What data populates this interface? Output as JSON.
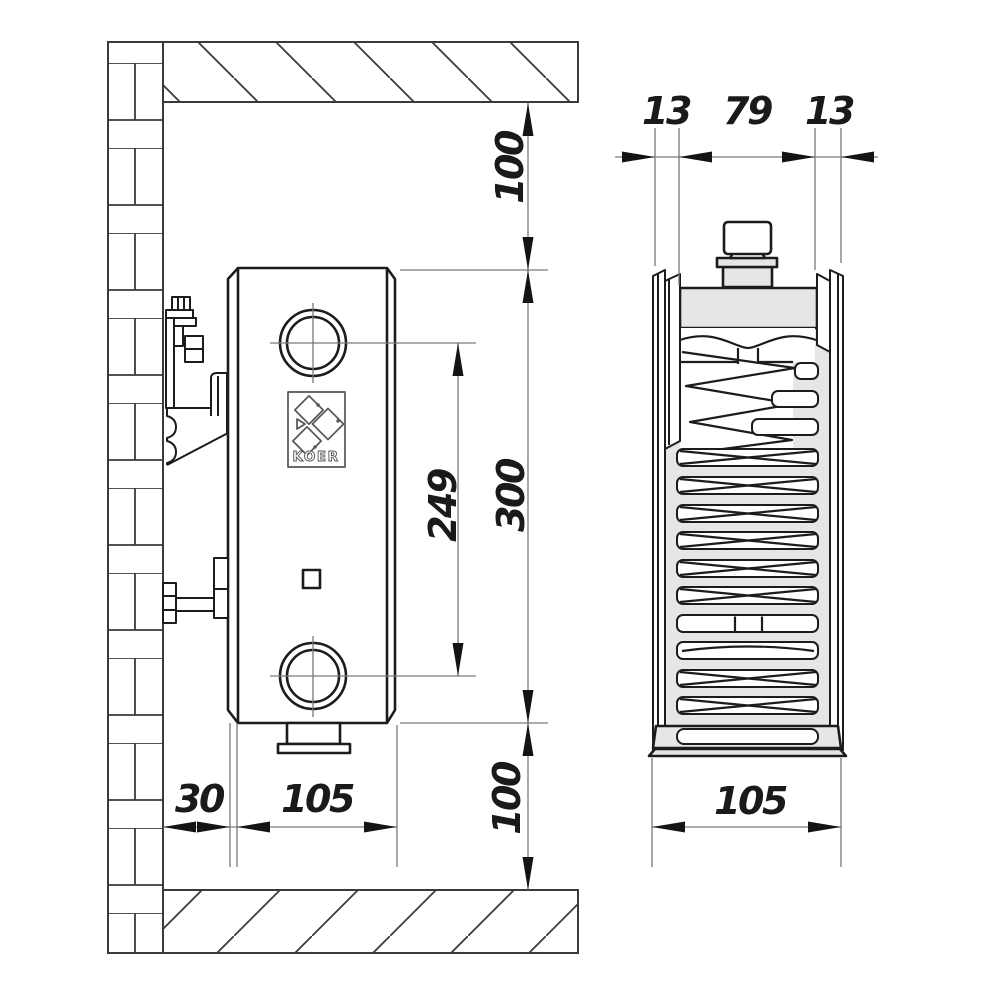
{
  "drawing": {
    "brand_logo": "KOER",
    "side_view": {
      "top_clearance": "100",
      "total_height": "300",
      "connection_spacing": "249",
      "bottom_clearance": "100",
      "wall_gap": "30",
      "depth": "105"
    },
    "section_view": {
      "front_panel": "13",
      "core": "79",
      "back_panel": "13",
      "total_depth": "105"
    },
    "colors": {
      "line": "#1c1c1c",
      "dim_line": "#7a7a7a",
      "light_fill": "#e6e6e6",
      "background": "#ffffff"
    }
  }
}
